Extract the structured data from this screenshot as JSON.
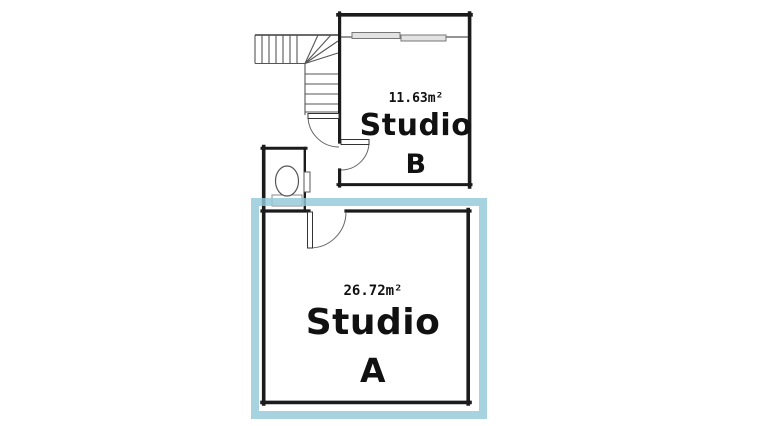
{
  "plan": {
    "type": "floorplan",
    "wall_color": "#1b1b1b",
    "highlight_color": "#A8D4E0",
    "rooms": {
      "studio_b": {
        "area": "11.63m²",
        "name": "Studio",
        "letter": "B"
      },
      "studio_a": {
        "area": "26.72m²",
        "name": "Studio",
        "letter": "A"
      }
    },
    "fixtures": {
      "staircase": "l-shaped-winder-staircase",
      "toilet": "toilet-icon",
      "window": "sliding-window",
      "doors": [
        "hall-door-swing",
        "studio-b-door-swing",
        "studio-a-door-swing",
        "toilet-door-leaf"
      ]
    }
  }
}
